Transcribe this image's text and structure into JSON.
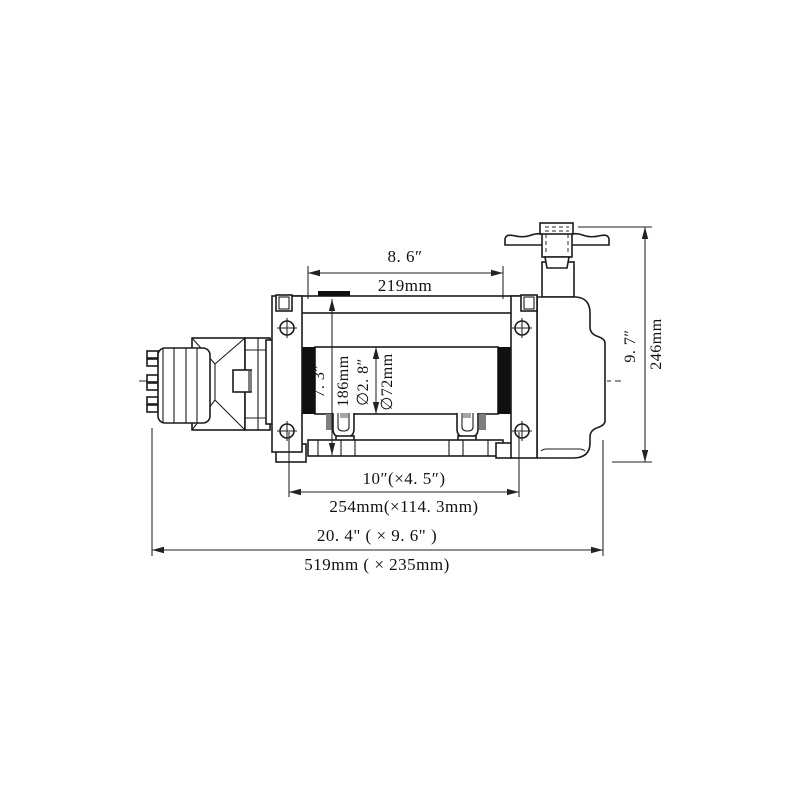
{
  "drawing": {
    "subject": "hydraulic-winch-side-view",
    "colors": {
      "background": "#ffffff",
      "line": "#1c1c1c",
      "flange_fill": "#101010",
      "hatch_fill": "#7f7f7f",
      "dimension_line": "#222222"
    },
    "dimensions": {
      "drum_length": {
        "inch": "8. 6″",
        "mm": "219mm"
      },
      "flange_diameter": {
        "inch": "7. 3″",
        "mm": "186mm"
      },
      "barrel_diameter": {
        "inch": "∅2. 8″",
        "mm": "∅72mm"
      },
      "overall_height": {
        "inch": "9. 7″",
        "mm": "246mm"
      },
      "mounting_pattern": {
        "inch": "10″(×4. 5″)",
        "mm": "254mm(×114. 3mm)"
      },
      "overall_length": {
        "inch": "20. 4\" ( × 9. 6\" )",
        "mm": "519mm ( × 235mm)"
      }
    }
  }
}
